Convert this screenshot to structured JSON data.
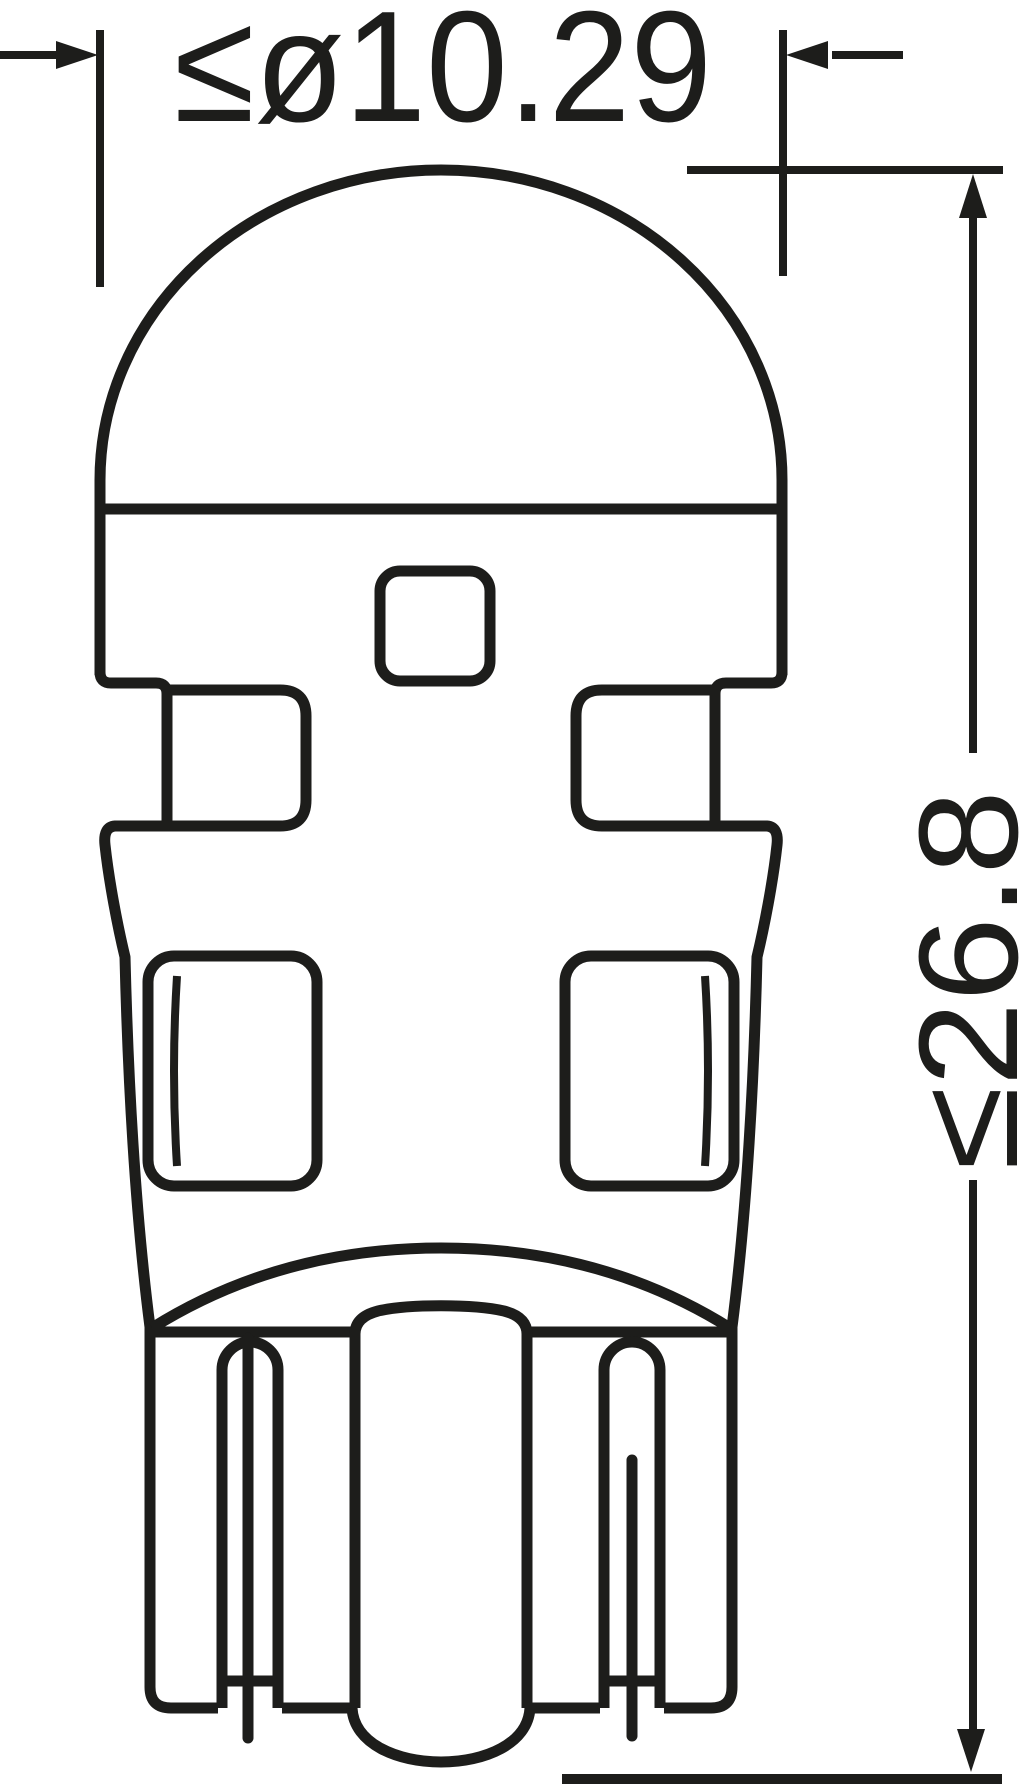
{
  "drawing": {
    "background_color": "#ffffff",
    "line_color": "#1d1d1b",
    "diameter_dimension": {
      "label": "≤ø10.29"
    },
    "height_dimension": {
      "label": "≤26.8"
    }
  }
}
